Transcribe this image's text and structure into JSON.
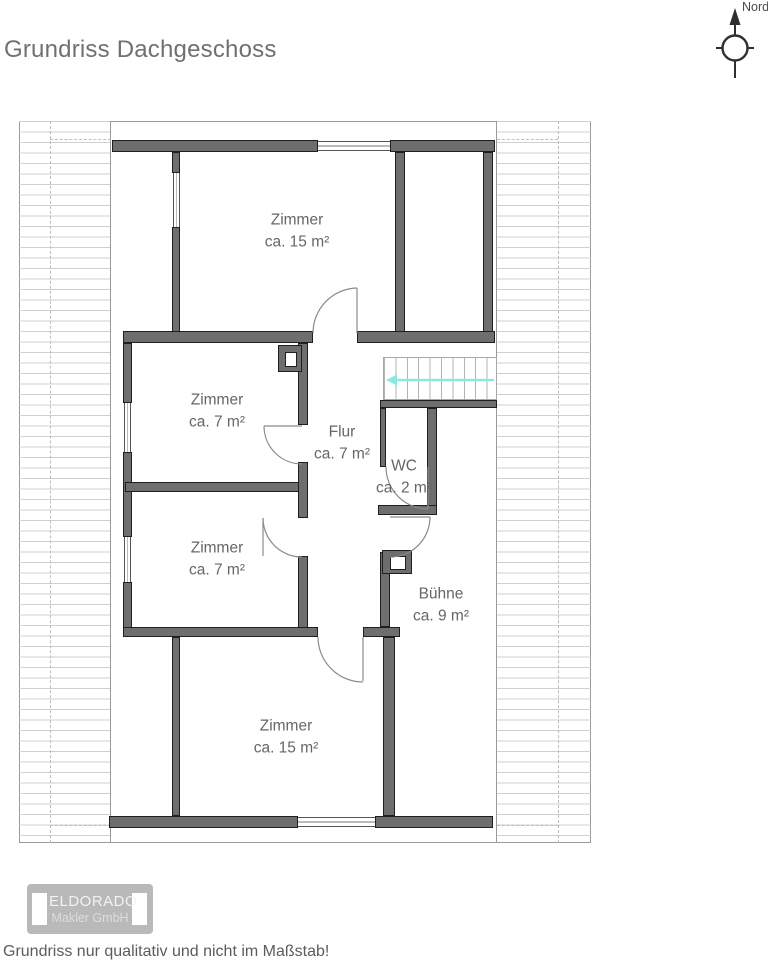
{
  "page": {
    "title": "Grundriss Dachgeschoss",
    "disclaimer": "Grundriss nur qualitativ und nicht im Maßstab!"
  },
  "compass": {
    "label": "Nord"
  },
  "rooms": [
    {
      "id": "zimmer-top",
      "name": "Zimmer",
      "area": "ca. 15 m²"
    },
    {
      "id": "zimmer-mid-upper",
      "name": "Zimmer",
      "area": "ca. 7 m²"
    },
    {
      "id": "flur",
      "name": "Flur",
      "area": "ca. 7 m²"
    },
    {
      "id": "wc",
      "name": "WC",
      "area": "ca. 2 m²"
    },
    {
      "id": "zimmer-mid-lower",
      "name": "Zimmer",
      "area": "ca. 7 m²"
    },
    {
      "id": "buehne",
      "name": "Bühne",
      "area": "ca. 9 m²"
    },
    {
      "id": "zimmer-bottom",
      "name": "Zimmer",
      "area": "ca. 15 m²"
    }
  ],
  "logo": {
    "line1": "ELDORADO",
    "line2": "Makler GmbH"
  },
  "colors": {
    "wall_fill": "#6e6e6e",
    "wall_outline": "#1f1f1f",
    "hatch_line": "#cfcfcf",
    "stair_arrow": "#8ae9e1",
    "door_arc": "#8a8a8a",
    "text_gray": "#666666",
    "logo_badge": "#b9b9b9"
  }
}
